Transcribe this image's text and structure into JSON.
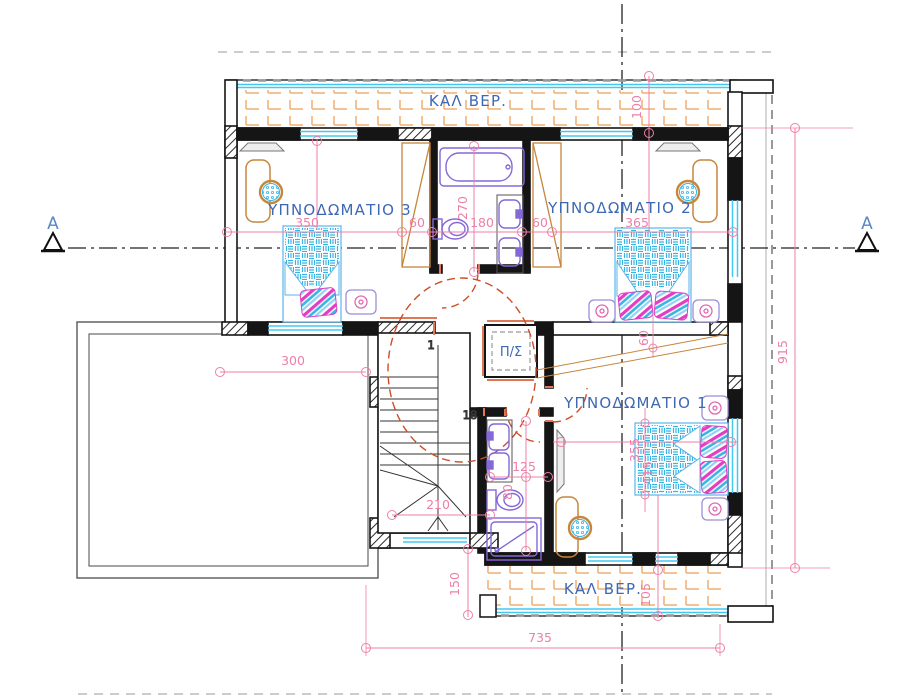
{
  "type": "architectural-floor-plan",
  "labels": {
    "bedroom3": "ΥΠΝΟΔΩΜΑΤΙΟ 3",
    "bedroom2": "ΥΠΝΟΔΩΜΑΤΙΟ 2",
    "bedroom1": "ΥΠΝΟΔΩΜΑΤΙΟ 1",
    "veranda_top": "ΚΑΛ ΒΕΡ.",
    "veranda_bottom": "ΚΑΛ ΒΕΡ.",
    "utility_closet": "Π/Σ",
    "section_left": "A",
    "section_right": "A",
    "stair_first_step": "1",
    "stair_last_step": "18"
  },
  "dimensions": {
    "bedroom3_width": "350",
    "bath_offset_left": "60",
    "bath_width": "180",
    "bath_offset_right": "60",
    "bedroom2_width": "365",
    "bath_depth": "270",
    "veranda_top_depth": "100",
    "terrace_width": "300",
    "stair_width": "210",
    "bath2_width": "125",
    "bath2_counter": "80",
    "bedroom2_gap": "60",
    "bedroom1_dim_a": "355",
    "bedroom1_dim_b": "415",
    "building_depth": "915",
    "stair_to_veranda": "150",
    "veranda_bottom_depth": "105",
    "building_width": "735"
  },
  "colors": {
    "dimension": "#ee7fa8",
    "label_blue": "#3d68b4",
    "window_cyan": "#45c8f0",
    "veranda_hatch": "#efae72",
    "fixture_purple": "#8468d8",
    "furniture_brown": "#c6863c",
    "door_red": "#cc4e28",
    "bed_cyan": "#38b4e4",
    "bed_magenta": "#e23ec4",
    "wall_black": "#151515"
  }
}
